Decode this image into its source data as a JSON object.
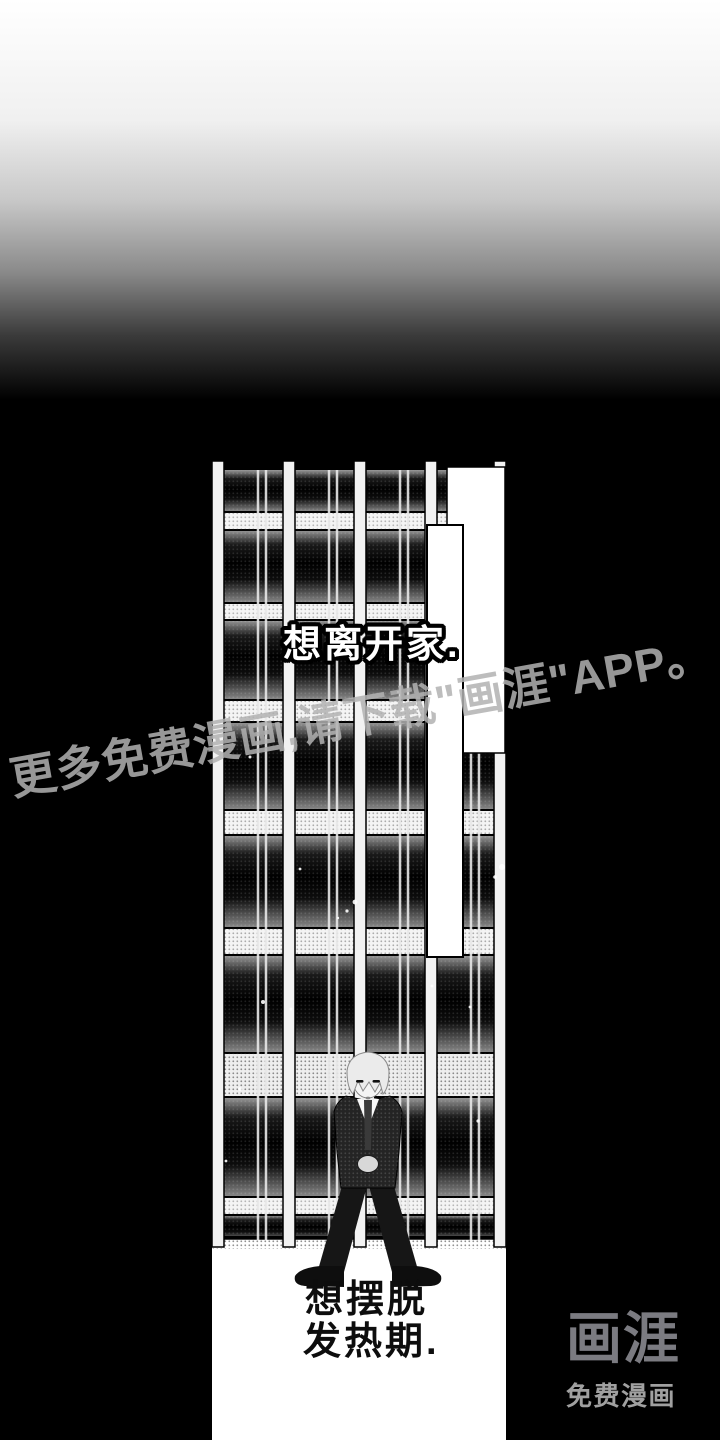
{
  "captions": {
    "top": "想离开家.",
    "bottom_line1": "想摆脱",
    "bottom_line2": "发热期."
  },
  "watermark": {
    "text": "更多免费漫画,请下载\"画涯\"APP。"
  },
  "logo": {
    "name": "画涯",
    "tagline": "免费漫画"
  },
  "colors": {
    "background": "#000000",
    "watermark_gray": "#b2b2b2",
    "logo_gray": "#7b7b81",
    "logo_tagline_gray": "#a0a0a0",
    "caption_top_fill": "#ffffff",
    "caption_top_outline": "#000000",
    "caption_bottom_ink": "#0d0d0d"
  }
}
